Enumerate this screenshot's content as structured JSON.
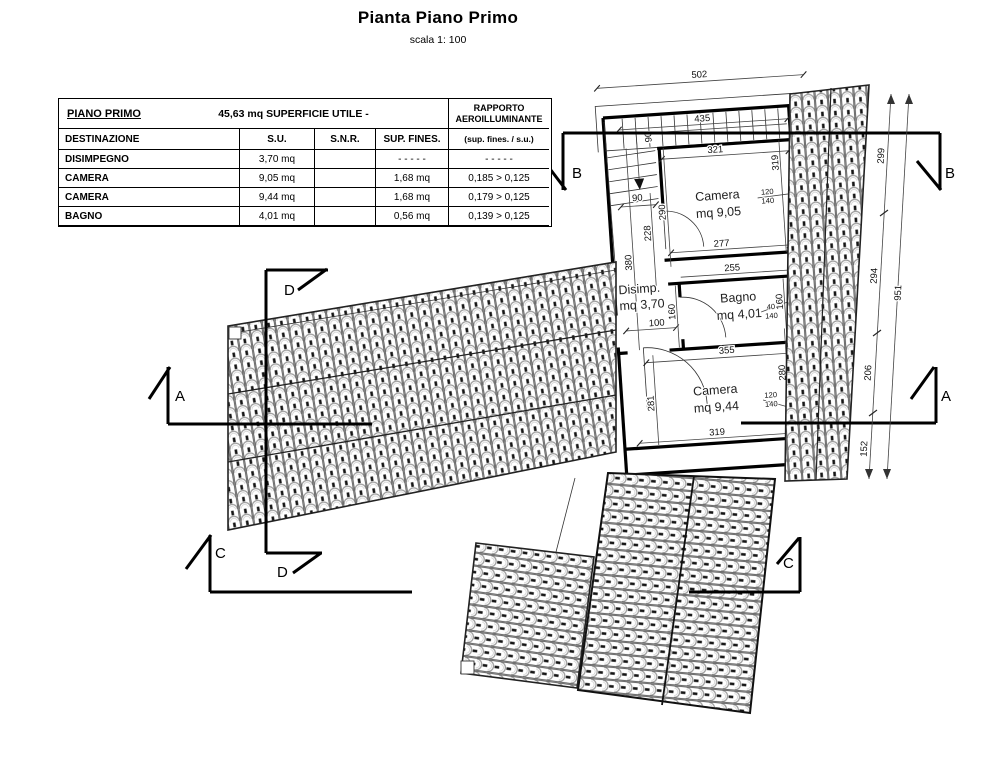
{
  "header": {
    "title": "Pianta Piano Primo",
    "scale": "scala 1: 100"
  },
  "table": {
    "floor_label": "PIANO PRIMO",
    "surface_summary": "45,63 mq SUPERFICIE UTILE -",
    "rapporto_line1": "RAPPORTO",
    "rapporto_line2": "AEROILLUMINANTE",
    "columns": [
      "DESTINAZIONE",
      "S.U.",
      "S.N.R.",
      "SUP. FINES.",
      "(sup. fines. / s.u.)"
    ],
    "rows": [
      {
        "destinazione": "DISIMPEGNO",
        "su": "3,70 mq",
        "snr": "",
        "sup_fines": "- - - - -",
        "rapporto": "- - - - -"
      },
      {
        "destinazione": "CAMERA",
        "su": "9,05 mq",
        "snr": "",
        "sup_fines": "1,68 mq",
        "rapporto": "0,185  >  0,125"
      },
      {
        "destinazione": "CAMERA",
        "su": "9,44 mq",
        "snr": "",
        "sup_fines": "1,68 mq",
        "rapporto": "0,179  >  0,125"
      },
      {
        "destinazione": "BAGNO",
        "su": "4,01 mq",
        "snr": "",
        "sup_fines": "0,56 mq",
        "rapporto": "0,139  >  0,125"
      }
    ]
  },
  "plan": {
    "rooms": [
      {
        "name": "Camera",
        "area": "mq 9,05"
      },
      {
        "name": "Bagno",
        "area": "mq 4,01"
      },
      {
        "name": "Disimp.",
        "area": "mq 3,70"
      },
      {
        "name": "Camera",
        "area": "mq 9,44"
      }
    ],
    "dims": {
      "overall_width": "502",
      "stair_run": "435",
      "stair_width": "90",
      "landing_width": "90",
      "v290": "290",
      "v228": "228",
      "v380": "380",
      "camera1_width": "321",
      "camera1_height": "319",
      "camera1_bottom": "277",
      "bagno_width": "255",
      "bagno_height_left": "160",
      "bagno_height_right": "160",
      "door_width": "100",
      "mid_width": "355",
      "camera2_height_left": "281",
      "camera2_height_right": "280",
      "camera2_bottom": "319",
      "win1_w": "120",
      "win1_h": "140",
      "win2_w": "40",
      "win2_h": "140",
      "win3_w": "120",
      "win3_h": "140",
      "chain": [
        "299",
        "294",
        "206",
        "152"
      ],
      "chain_total": "951"
    },
    "sections": {
      "a": "A",
      "b": "B",
      "c": "C",
      "d": "D"
    }
  }
}
